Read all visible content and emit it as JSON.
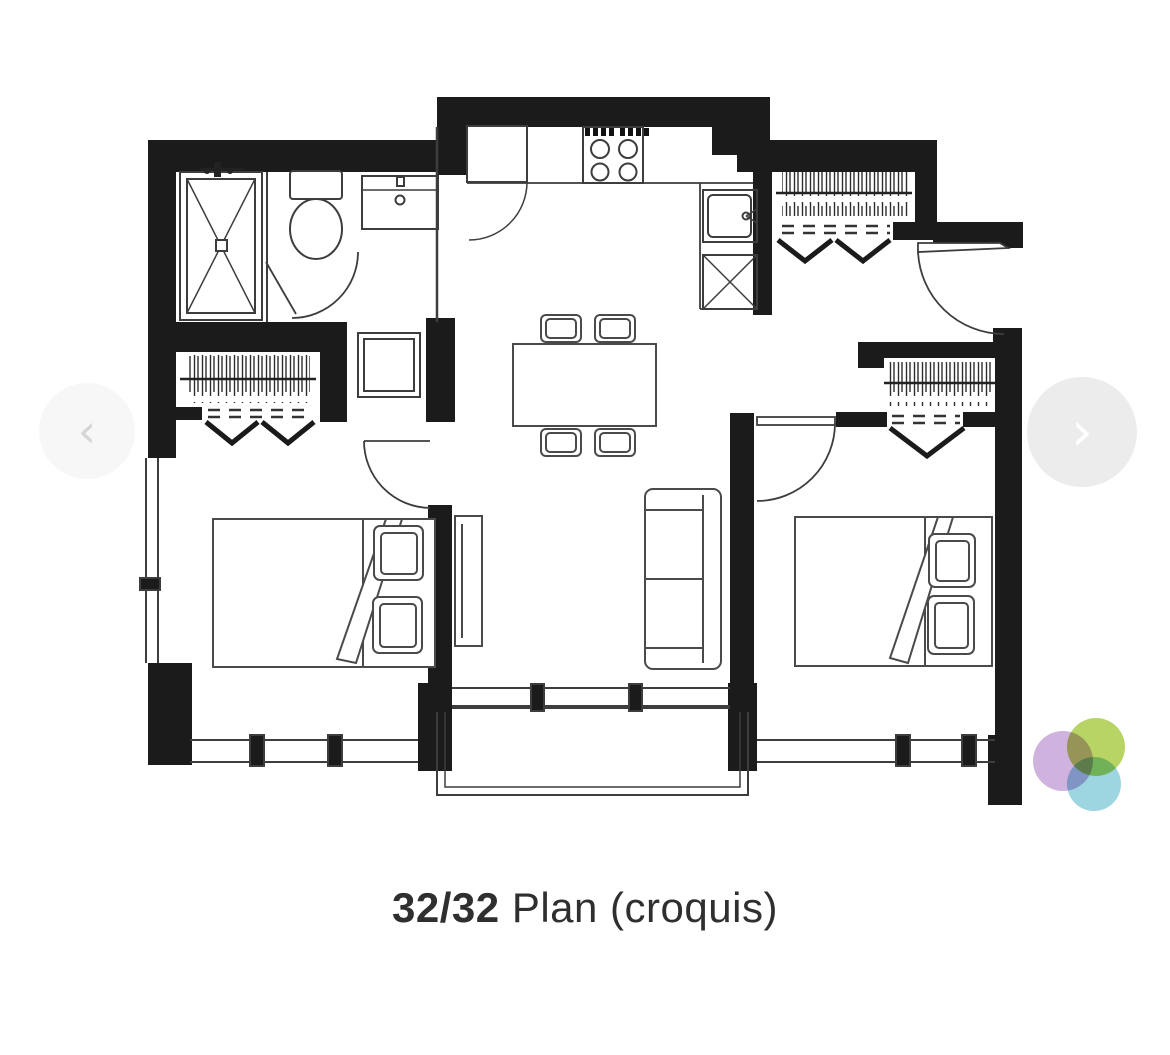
{
  "caption": {
    "counter": "32/32",
    "label": "Plan (croquis)"
  },
  "carousel": {
    "prev_symbol": "‹",
    "next_symbol": "›"
  },
  "colors": {
    "wall": "#1b1b1b",
    "line": "#3d3d3d",
    "caption_text": "#2f2f2f",
    "arrow_bg_left": "#f7f7f7",
    "arrow_bg_right": "#ececec",
    "arrow_chevron_left": "#d6d6d6",
    "arrow_chevron_right": "#ffffff"
  },
  "logo": {
    "circles": [
      {
        "name": "purple",
        "color": "#c49fd6"
      },
      {
        "name": "green",
        "color": "#a6c93d"
      },
      {
        "name": "cyan",
        "color": "#84ccd8"
      }
    ]
  }
}
